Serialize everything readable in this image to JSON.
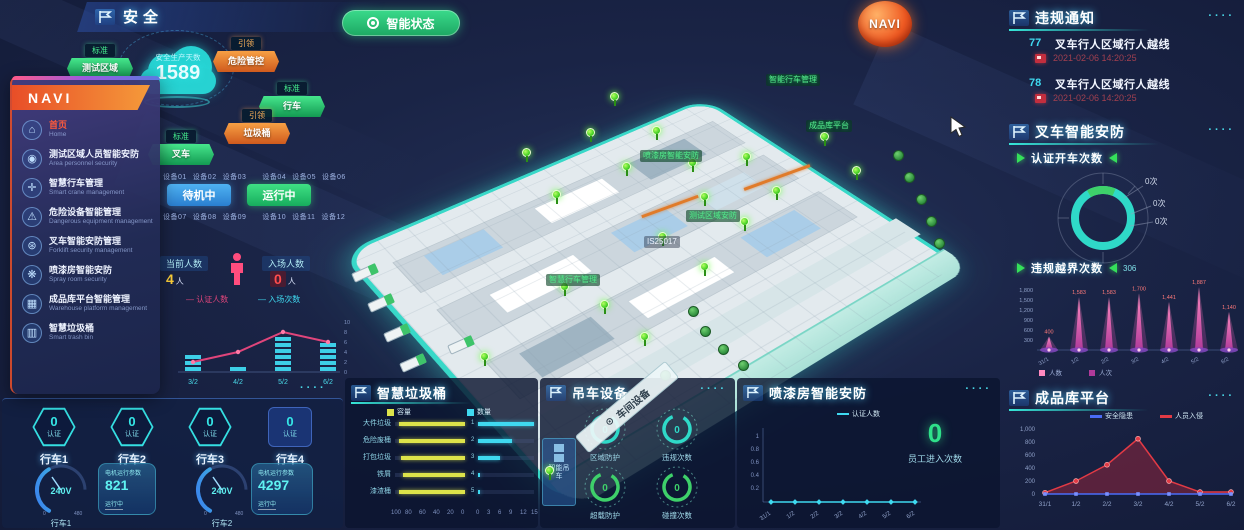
{
  "app": {
    "title": "安全",
    "status_button_label": "智能状态",
    "navi_badge": "NAVI",
    "panel_dots": "····"
  },
  "colors": {
    "accent": "#35e0e0",
    "green": "#2fd483",
    "orange": "#f07c2e",
    "magenta": "#e84fa0",
    "yellow": "#dde34a",
    "red": "#e23a45",
    "blue": "#4a6cf7",
    "pink_line": "#e0457b"
  },
  "cloud": {
    "label": "安全生产天数",
    "value": "1589"
  },
  "badges": [
    {
      "tier": "标准",
      "name": "测试区域",
      "type": "green",
      "x": 67,
      "y": 40
    },
    {
      "tier": "引领",
      "name": "危险管控",
      "type": "orange",
      "x": 213,
      "y": 33
    },
    {
      "tier": "标准",
      "name": "行车",
      "type": "green",
      "x": 259,
      "y": 78
    },
    {
      "tier": "引领",
      "name": "垃圾桶",
      "type": "orange",
      "x": 224,
      "y": 105
    },
    {
      "tier": "标准",
      "name": "叉车",
      "type": "green",
      "x": 148,
      "y": 126
    }
  ],
  "sidebar": {
    "title": "NAVI",
    "items": [
      {
        "icon": "home-icon",
        "label": "首页",
        "sub": "Home",
        "active": true
      },
      {
        "icon": "people-icon",
        "label": "测试区域人员智能安防",
        "sub": "Area personnel security",
        "active": false
      },
      {
        "icon": "crane-icon",
        "label": "智慧行车管理",
        "sub": "Smart crane management",
        "active": false
      },
      {
        "icon": "warning-icon",
        "label": "危险设备智能管理",
        "sub": "Dangerous equipment management",
        "active": false
      },
      {
        "icon": "forklift-icon",
        "label": "叉车智能安防管理",
        "sub": "Forklift security management",
        "active": false
      },
      {
        "icon": "spray-icon",
        "label": "喷漆房智能安防",
        "sub": "Spray room security",
        "active": false
      },
      {
        "icon": "warehouse-icon",
        "label": "成品库平台智能管理",
        "sub": "Warehouse platform management",
        "active": false
      },
      {
        "icon": "trash-icon",
        "label": "智慧垃圾桶",
        "sub": "Smart trash bin",
        "active": false
      }
    ]
  },
  "controls": {
    "tags_row1": [
      "设备01",
      "设备02",
      "设备03",
      "设备04",
      "设备05",
      "设备06"
    ],
    "tags_row2": [
      "设备07",
      "设备08",
      "设备09",
      "设备10",
      "设备11",
      "设备12"
    ],
    "blue_button": "待机中",
    "green_button": "运行中"
  },
  "people": {
    "current_label": "当前人数",
    "current_value": "4",
    "current_unit": "人",
    "enter_label": "入场人数",
    "enter_value": "0",
    "enter_unit": "人"
  },
  "entry_chart": {
    "type": "bar+line",
    "legend": [
      "认证人数",
      "入场次数"
    ],
    "categories": [
      "3/2",
      "4/2",
      "5/2",
      "6/2"
    ],
    "bars": [
      3,
      1,
      6,
      5
    ],
    "line": [
      2,
      4,
      8,
      6
    ],
    "y_ticks": [
      10,
      8,
      6,
      4,
      2,
      0
    ]
  },
  "crane_block": {
    "hexes": [
      {
        "name": "行车1",
        "value": "0",
        "label": "认证"
      },
      {
        "name": "行车2",
        "value": "0",
        "label": "认证"
      },
      {
        "name": "行车3",
        "value": "0",
        "label": "认证"
      },
      {
        "name": "行车4",
        "value": "0",
        "label": "认证"
      }
    ],
    "gauges": [
      {
        "name": "行车1",
        "value": "240V",
        "min": "0",
        "max": "480"
      },
      {
        "name": "行车2",
        "value": "240V",
        "min": "0",
        "max": "480"
      }
    ],
    "cards": [
      {
        "title": "电机运行参数",
        "value": "821",
        "sub": "运行中"
      },
      {
        "title": "电机运行参数",
        "value": "4297",
        "sub": "运行中"
      }
    ]
  },
  "trash_panel": {
    "title": "智慧垃圾桶",
    "legend_left": "容量",
    "legend_right": "数量",
    "left_chart": {
      "type": "bar",
      "categories": [
        "大件垃圾",
        "危险废桶",
        "打包垃圾",
        "铁屑",
        "漆渣桶"
      ],
      "values": [
        95,
        95,
        92,
        88,
        95
      ],
      "axis": [
        100,
        80,
        60,
        40,
        20,
        0
      ]
    },
    "right_chart": {
      "type": "bar",
      "categories": [
        "1",
        "2",
        "3",
        "4",
        "5"
      ],
      "values": [
        15,
        9,
        6,
        0.5,
        0.5
      ],
      "axis": [
        0,
        3,
        6,
        9,
        12,
        15
      ]
    }
  },
  "crane_panel": {
    "title": "吊车设备",
    "side_box": "智能吊车",
    "rings": [
      {
        "label": "区域防护",
        "value": "0",
        "color": "#2fd9c8"
      },
      {
        "label": "违规次数",
        "value": "0",
        "color": "#2fd9c8"
      },
      {
        "label": "超载防护",
        "value": "0",
        "color": "#3ed06a"
      },
      {
        "label": "碰撞次数",
        "value": "0",
        "color": "#3ed06a"
      }
    ]
  },
  "paint_panel": {
    "title": "喷漆房智能安防",
    "legend": "认证人数",
    "chart": {
      "type": "line",
      "y_ticks": [
        1,
        0.8,
        0.6,
        0.4,
        0.2
      ],
      "categories": [
        "31/1",
        "1/2",
        "2/2",
        "3/2",
        "4/2",
        "5/2",
        "6/2"
      ],
      "values": [
        0,
        0,
        0,
        0,
        0,
        0,
        0
      ]
    },
    "big_value": "0",
    "big_label": "员工进入次数"
  },
  "violation_panel": {
    "title": "违规通知",
    "rows": [
      {
        "id": "77",
        "title": "叉车行人区域行人越线",
        "time": "2021-02-06 14:20:25"
      },
      {
        "id": "78",
        "title": "叉车行人区域行人越线",
        "time": "2021-02-06 14:20:25"
      }
    ]
  },
  "forklift_panel": {
    "title": "叉车智能安防",
    "sub": "认证开车次数",
    "donut_labels": [
      "0次",
      "0次",
      "0次"
    ]
  },
  "cross_chart": {
    "title": "违规越界次数",
    "badge": "306",
    "type": "bar",
    "y_tick_labels": [
      "1,800",
      "1,500",
      "1,200",
      "900",
      "600",
      "300"
    ],
    "categories": [
      "31/1",
      "1/2",
      "2/2",
      "3/2",
      "4/2",
      "5/2",
      "6/2"
    ],
    "values": [
      400,
      1583,
      1583,
      1700,
      1441,
      1887,
      1140
    ],
    "value_labels": [
      "400",
      "1,583",
      "1,583",
      "1,700",
      "1,441",
      "1,887",
      "1,140"
    ],
    "legend": [
      "人数",
      "人次"
    ]
  },
  "warehouse_panel": {
    "title": "成品库平台",
    "type": "line",
    "legend": [
      {
        "label": "安全隐患",
        "color": "#4a6cf7"
      },
      {
        "label": "人员入侵",
        "color": "#e23a45"
      }
    ],
    "y_tick_labels": [
      "1,000",
      "800",
      "600",
      "400",
      "200",
      "0"
    ],
    "categories": [
      "31/1",
      "1/2",
      "2/2",
      "3/2",
      "4/2",
      "5/2",
      "6/2"
    ],
    "red": [
      20,
      200,
      450,
      850,
      200,
      30,
      30
    ],
    "blue": [
      0,
      0,
      0,
      0,
      0,
      0,
      0
    ]
  },
  "map": {
    "ribbon": "车间设备",
    "labels": [
      {
        "text": "智能行车管理",
        "x": 766,
        "y": 74
      },
      {
        "text": "成品库平台",
        "x": 806,
        "y": 120
      },
      {
        "text": "喷漆房智能安防",
        "x": 640,
        "y": 150
      },
      {
        "text": "测试区域安防",
        "x": 686,
        "y": 210
      },
      {
        "text": "智慧行车管理",
        "x": 546,
        "y": 274
      },
      {
        "text": "IS25017",
        "x": 644,
        "y": 236,
        "plain": true
      }
    ],
    "pins": [
      [
        522,
        148
      ],
      [
        552,
        190
      ],
      [
        586,
        128
      ],
      [
        622,
        162
      ],
      [
        652,
        126
      ],
      [
        688,
        158
      ],
      [
        700,
        192
      ],
      [
        742,
        152
      ],
      [
        772,
        186
      ],
      [
        820,
        132
      ],
      [
        852,
        166
      ],
      [
        658,
        232
      ],
      [
        700,
        262
      ],
      [
        740,
        217
      ],
      [
        600,
        300
      ],
      [
        640,
        332
      ],
      [
        560,
        282
      ],
      [
        480,
        352
      ],
      [
        545,
        466
      ],
      [
        610,
        92
      ]
    ],
    "trucks": [
      [
        352,
        268
      ],
      [
        368,
        298
      ],
      [
        384,
        328
      ],
      [
        400,
        358
      ],
      [
        448,
        340
      ]
    ],
    "trees": [
      [
        893,
        150
      ],
      [
        904,
        172
      ],
      [
        916,
        194
      ],
      [
        926,
        216
      ],
      [
        934,
        238
      ],
      [
        700,
        326
      ],
      [
        718,
        344
      ],
      [
        738,
        360
      ],
      [
        688,
        306
      ],
      [
        660,
        370
      ]
    ],
    "beams": [
      [
        742,
        176,
        70
      ],
      [
        640,
        205,
        60
      ]
    ]
  }
}
